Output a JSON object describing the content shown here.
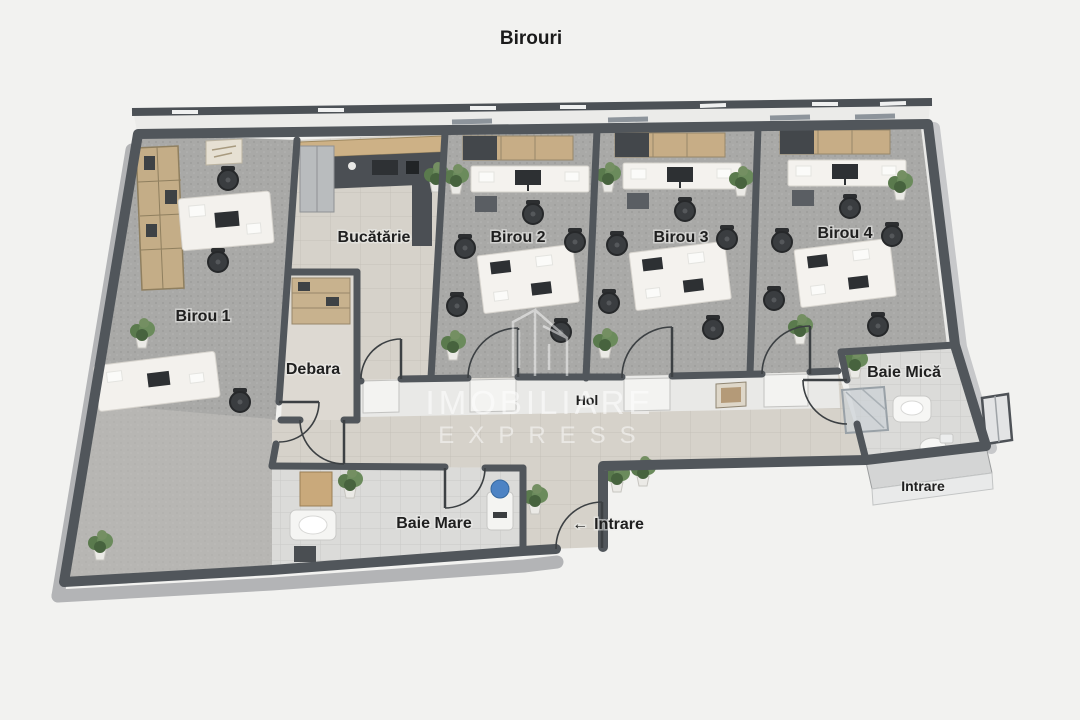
{
  "title": "Birouri",
  "plan": {
    "rooms": [
      {
        "id": "birou-1",
        "label": "Birou 1"
      },
      {
        "id": "bucatarie",
        "label": "Bucătărie"
      },
      {
        "id": "birou-2",
        "label": "Birou 2"
      },
      {
        "id": "birou-3",
        "label": "Birou 3"
      },
      {
        "id": "birou-4",
        "label": "Birou 4"
      },
      {
        "id": "debara",
        "label": "Debara"
      },
      {
        "id": "hol",
        "label": "Hol"
      },
      {
        "id": "baie-mica",
        "label": "Baie Mică"
      },
      {
        "id": "baie-mare",
        "label": "Baie Mare"
      }
    ],
    "entrance": {
      "step_label": "Intrare",
      "door_label": "Intrare",
      "arrow": "←"
    }
  },
  "watermark": {
    "line1": "IMOBILIARE",
    "line2": "EXPRESS"
  },
  "colors": {
    "background": "#f2f2f0",
    "walls": "#51565b",
    "office_carpet": "#a9a9a7",
    "hall_tile": "#d6d2ca",
    "bath_tile": "#dbdbd9",
    "wood": "#c7ad86",
    "plant_green": "#5a7a4d",
    "water_cooler_blue": "#4d83c4",
    "label_text": "#1f1f1f",
    "watermark": "#ffffff"
  }
}
